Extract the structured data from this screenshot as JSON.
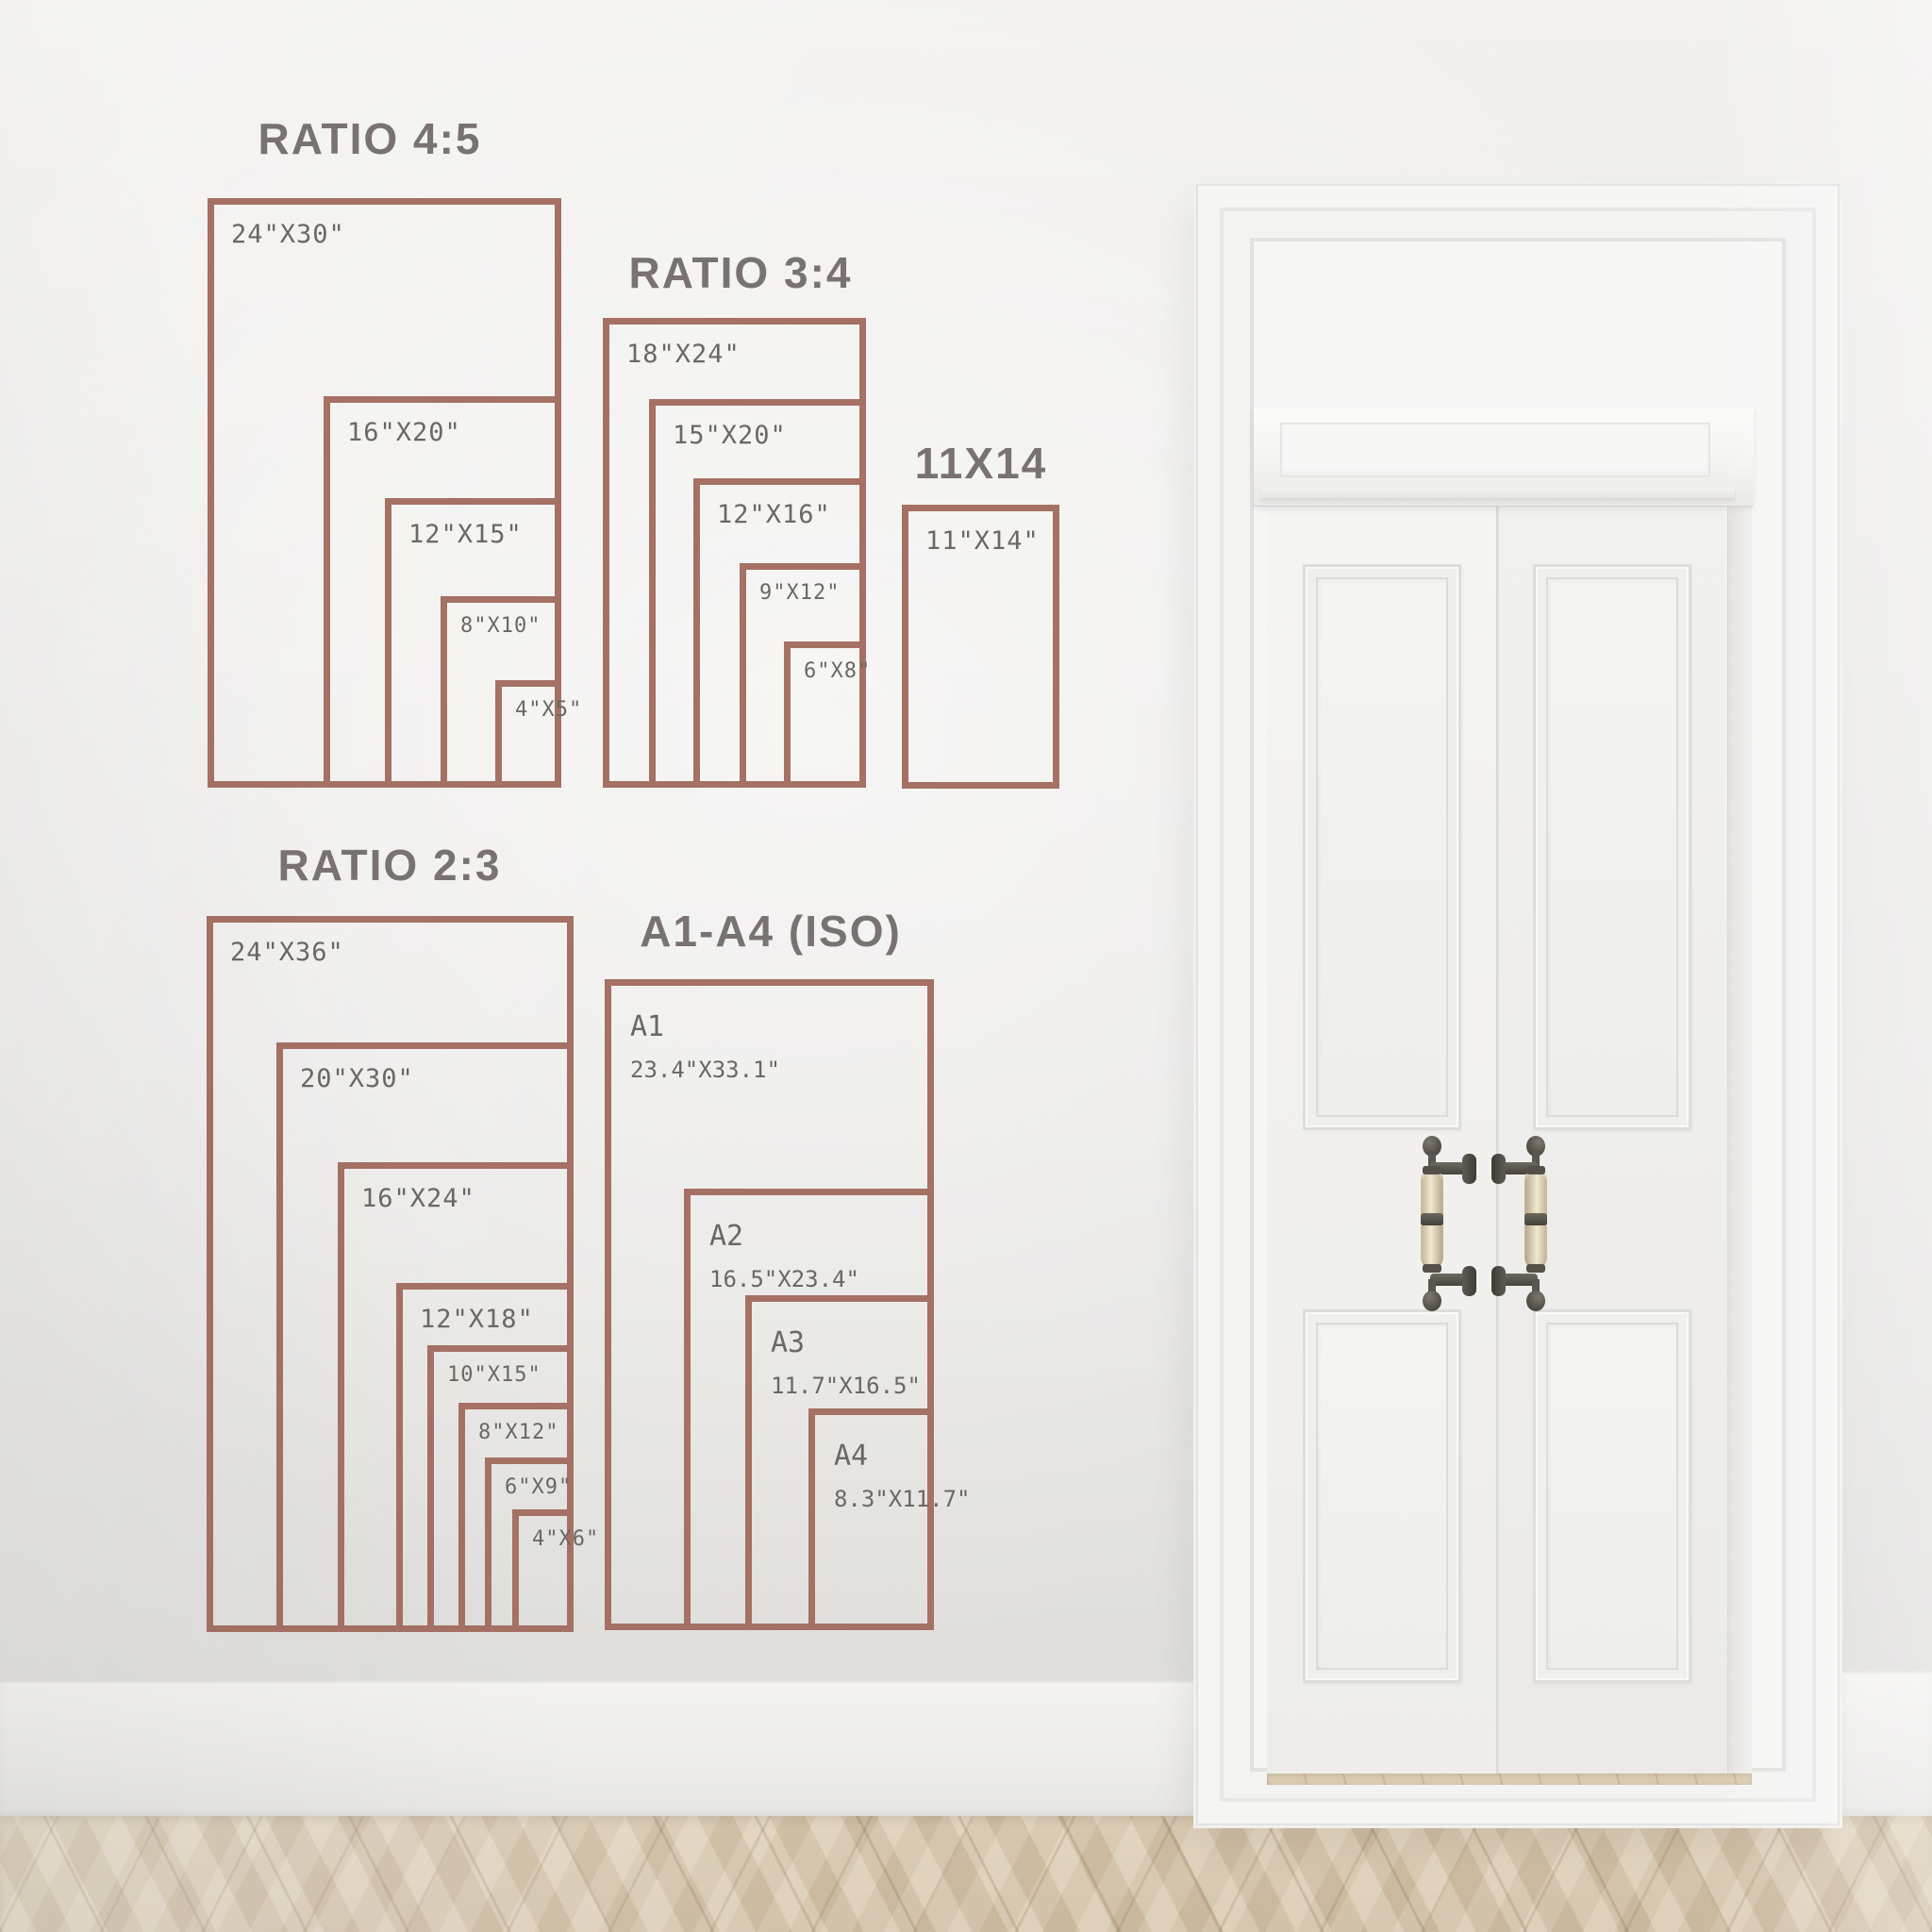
{
  "theme": {
    "accent": "#a57164",
    "label_color": "#6c6762",
    "title_color": "#7a7270",
    "wall_light": "#f2f1ef",
    "wall_mid": "#e9e8e6",
    "wall_dark": "#dcdbd9",
    "door_white": "#f6f6f5",
    "floor_base": "#d5c3a6",
    "handle_metal": "#57534c",
    "handle_grip": "#e9dec6"
  },
  "groups": [
    {
      "title": "RATIO 4:5",
      "sizes": [
        {
          "label": "24\"X30\""
        },
        {
          "label": "16\"X20\""
        },
        {
          "label": "12\"X15\""
        },
        {
          "label": "8\"X10\""
        },
        {
          "label": "4\"X5\""
        }
      ]
    },
    {
      "title": "RATIO 3:4",
      "sizes": [
        {
          "label": "18\"X24\""
        },
        {
          "label": "15\"X20\""
        },
        {
          "label": "12\"X16\""
        },
        {
          "label": "9\"X12\""
        },
        {
          "label": "6\"X8\""
        }
      ]
    },
    {
      "title": "11X14",
      "sizes": [
        {
          "label": "11\"X14\""
        }
      ]
    },
    {
      "title": "RATIO 2:3",
      "sizes": [
        {
          "label": "24\"X36\""
        },
        {
          "label": "20\"X30\""
        },
        {
          "label": "16\"X24\""
        },
        {
          "label": "12\"X18\""
        },
        {
          "label": "10\"X15\""
        },
        {
          "label": "8\"X12\""
        },
        {
          "label": "6\"X9\""
        },
        {
          "label": "4\"X6\""
        }
      ]
    },
    {
      "title": "A1-A4 (ISO)",
      "sizes": [
        {
          "name": "A1",
          "dims": "23.4\"X33.1\""
        },
        {
          "name": "A2",
          "dims": "16.5\"X23.4\""
        },
        {
          "name": "A3",
          "dims": "11.7\"X16.5\""
        },
        {
          "name": "A4",
          "dims": "8.3\"X11.7\""
        }
      ]
    }
  ]
}
